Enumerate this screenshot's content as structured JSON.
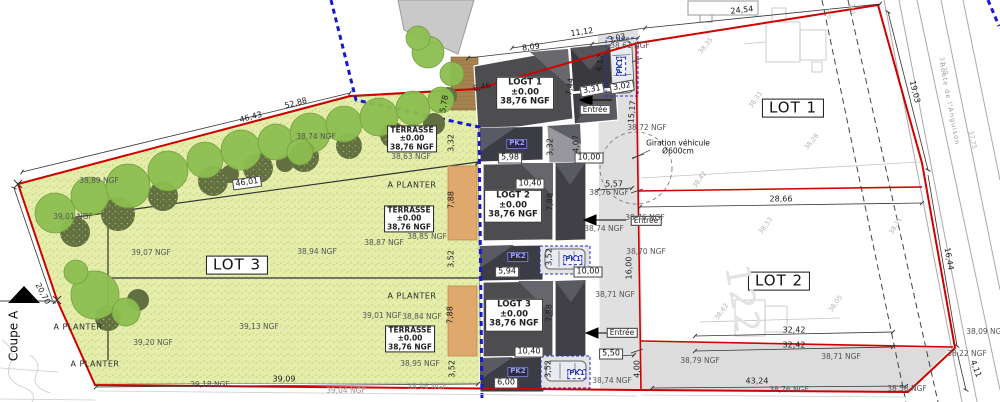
{
  "plan": {
    "type": "plan de masse / site plan",
    "colors": {
      "boundary_red": "#d10000",
      "zone_blue_dashed": "#1818cf",
      "lawn": "#e4edaa",
      "tree_canopy": "#8dbe51",
      "tree_shadow": "#626f40",
      "building_dark": "#4d4d50",
      "terrace_tan": "#dfa96e",
      "drive_gray": "#e0e0e0"
    }
  },
  "labels": [
    {
      "n": "lot1-label",
      "c": "lot",
      "t": "LOT 1",
      "x": 793,
      "y": 108
    },
    {
      "n": "lot2-label",
      "c": "lot",
      "t": "LOT 2",
      "x": 779,
      "y": 281
    },
    {
      "n": "lot3-label",
      "c": "lot",
      "t": "LOT 3",
      "x": 237,
      "y": 265
    },
    {
      "n": "logt1-label",
      "c": "bld",
      "t": "LOGT 1\n±0.00\n38,76 NGF",
      "x": 525,
      "y": 93
    },
    {
      "n": "logt2-label",
      "c": "bld",
      "t": "LOGT 2\n±0.00\n38,76 NGF",
      "x": 513,
      "y": 206
    },
    {
      "n": "logt3-label",
      "c": "bld",
      "t": "LOGT 3\n±0.00\n38,76 NGF",
      "x": 514,
      "y": 315
    },
    {
      "n": "terrasse-label-1",
      "c": "terr",
      "t": "TERRASSE\n±0.00\n38,76 NGF",
      "x": 412,
      "y": 139
    },
    {
      "n": "terrasse-label-2",
      "c": "terr",
      "t": "TERRASSE\n±0.00\n38,76 NGF",
      "x": 409,
      "y": 219
    },
    {
      "n": "terrasse-label-3",
      "c": "terr",
      "t": "TERRASSE\n±0.00\n38,76 NGF",
      "x": 410,
      "y": 339
    },
    {
      "n": "a-planter-label",
      "c": "plant",
      "t": "A PLANTER",
      "x": 412,
      "y": 186
    },
    {
      "n": "a-planter-label",
      "c": "plant",
      "t": "A PLANTER",
      "x": 412,
      "y": 297
    },
    {
      "n": "a-planter-label",
      "c": "plant",
      "t": "A PLANTER",
      "x": 78,
      "y": 328
    },
    {
      "n": "a-planter-label",
      "c": "plant",
      "t": "A PLANTER",
      "x": 95,
      "y": 365
    },
    {
      "n": "entree-label-logt1",
      "c": "ent",
      "t": "Entrée",
      "x": 595,
      "y": 110
    },
    {
      "n": "entree-label-logt2",
      "c": "ent",
      "t": "Entrée",
      "x": 646,
      "y": 221
    },
    {
      "n": "entree-label-logt3",
      "c": "ent",
      "t": "Entrée",
      "x": 622,
      "y": 333
    },
    {
      "n": "giration-label",
      "c": "gir",
      "t": "Giration véhicule\nØ600cm",
      "x": 678,
      "y": 148
    },
    {
      "n": "pk2-label",
      "c": "pk2",
      "t": "PK2",
      "x": 517,
      "y": 144
    },
    {
      "n": "pk2-label",
      "c": "pk2",
      "t": "PK2",
      "x": 518,
      "y": 257
    },
    {
      "n": "pk2-label",
      "c": "pk2",
      "t": "PK2",
      "x": 518,
      "y": 372
    },
    {
      "n": "pk1-label",
      "c": "pk1",
      "t": "PK1",
      "x": 621,
      "y": 66,
      "r": -90
    },
    {
      "n": "pk1-label",
      "c": "pk1",
      "t": "PK1",
      "x": 573,
      "y": 260
    },
    {
      "n": "pk1-label",
      "c": "pk1",
      "t": "PK1",
      "x": 577,
      "y": 374
    },
    {
      "n": "dimension-label",
      "c": "dimbox",
      "t": "46,01",
      "x": 247,
      "y": 183,
      "r": -8
    },
    {
      "n": "dimension-label",
      "c": "dimbox",
      "t": "5,98",
      "x": 510,
      "y": 158
    },
    {
      "n": "dimension-label",
      "c": "dimbox",
      "t": "10,00",
      "x": 589,
      "y": 158
    },
    {
      "n": "dimension-label",
      "c": "dimbox",
      "t": "10,40",
      "x": 530,
      "y": 184
    },
    {
      "n": "dimension-label",
      "c": "dimbox",
      "t": "5,94",
      "x": 507,
      "y": 272
    },
    {
      "n": "dimension-label",
      "c": "dimbox",
      "t": "10,00",
      "x": 588,
      "y": 272
    },
    {
      "n": "dimension-label",
      "c": "dimbox",
      "t": "10,40",
      "x": 529,
      "y": 352
    },
    {
      "n": "dimension-label",
      "c": "dimbox",
      "t": "5,50",
      "x": 611,
      "y": 354
    },
    {
      "n": "dimension-label",
      "c": "dimbox",
      "t": "6,00",
      "x": 506,
      "y": 383
    },
    {
      "n": "dimension-label",
      "c": "dimbox",
      "t": "3,31",
      "x": 592,
      "y": 90,
      "r": -10
    },
    {
      "n": "dimension-label",
      "c": "dimbox",
      "t": "3,02",
      "x": 622,
      "y": 87,
      "r": -10
    },
    {
      "n": "dimension-label",
      "c": "dim",
      "t": "24,54",
      "x": 742,
      "y": 11,
      "r": -6
    },
    {
      "n": "dimension-label",
      "c": "dim",
      "t": "11,12",
      "x": 582,
      "y": 33,
      "r": -8
    },
    {
      "n": "dimension-label",
      "c": "dim",
      "t": "8,09",
      "x": 531,
      "y": 48,
      "r": -7
    },
    {
      "n": "dimension-label",
      "c": "dim",
      "t": "3,03",
      "x": 617,
      "y": 39,
      "r": -12
    },
    {
      "n": "dimension-label",
      "c": "dim",
      "t": "6,46",
      "x": 482,
      "y": 88,
      "r": -11
    },
    {
      "n": "dimension-label",
      "c": "dim",
      "t": "52,88",
      "x": 296,
      "y": 104,
      "r": -15
    },
    {
      "n": "dimension-label",
      "c": "dim",
      "t": "46,43",
      "x": 251,
      "y": 118,
      "r": -15
    },
    {
      "n": "dimension-label",
      "c": "dim",
      "t": "28,66",
      "x": 781,
      "y": 200
    },
    {
      "n": "dimension-label",
      "c": "dim",
      "t": "32,42",
      "x": 794,
      "y": 331
    },
    {
      "n": "dimension-label",
      "c": "dim",
      "t": "32,42",
      "x": 794,
      "y": 346
    },
    {
      "n": "dimension-label",
      "c": "dim",
      "t": "43,24",
      "x": 757,
      "y": 382
    },
    {
      "n": "dimension-label",
      "c": "dim",
      "t": "39,09",
      "x": 284,
      "y": 380
    },
    {
      "n": "dimension-label",
      "c": "dim",
      "t": "5,57",
      "x": 614,
      "y": 185
    },
    {
      "n": "dimension-label",
      "c": "dim",
      "t": "3,32",
      "x": 452,
      "y": 143,
      "r": -90
    },
    {
      "n": "dimension-label",
      "c": "dim",
      "t": "3,32",
      "x": 551,
      "y": 147,
      "r": -90
    },
    {
      "n": "dimension-label",
      "c": "dim",
      "t": "7,88",
      "x": 452,
      "y": 200,
      "r": -90
    },
    {
      "n": "dimension-label",
      "c": "dim",
      "t": "7,88",
      "x": 551,
      "y": 202,
      "r": -90
    },
    {
      "n": "dimension-label",
      "c": "dim",
      "t": "3,52",
      "x": 452,
      "y": 259,
      "r": -90
    },
    {
      "n": "dimension-label",
      "c": "dim",
      "t": "3,52",
      "x": 550,
      "y": 257,
      "r": -90
    },
    {
      "n": "dimension-label",
      "c": "dim",
      "t": "7,88",
      "x": 451,
      "y": 315,
      "r": -90
    },
    {
      "n": "dimension-label",
      "c": "dim",
      "t": "7,88",
      "x": 550,
      "y": 313,
      "r": -90
    },
    {
      "n": "dimension-label",
      "c": "dim",
      "t": "3,52",
      "x": 453,
      "y": 369,
      "r": -90
    },
    {
      "n": "dimension-label",
      "c": "dim",
      "t": "3,52",
      "x": 549,
      "y": 369,
      "r": -90
    },
    {
      "n": "dimension-label",
      "c": "dim",
      "t": "7,44",
      "x": 571,
      "y": 87,
      "r": -82
    },
    {
      "n": "dimension-label",
      "c": "dim",
      "t": "4,17",
      "x": 601,
      "y": 63,
      "r": -82
    },
    {
      "n": "dimension-label",
      "c": "dim",
      "t": "4,07",
      "x": 577,
      "y": 144,
      "r": -90
    },
    {
      "n": "dimension-label",
      "c": "dim",
      "t": "15,17",
      "x": 633,
      "y": 112,
      "r": -84
    },
    {
      "n": "dimension-label",
      "c": "dim",
      "t": "16,00",
      "x": 630,
      "y": 268,
      "r": -90
    },
    {
      "n": "dimension-label",
      "c": "dim",
      "t": "4,00",
      "x": 638,
      "y": 369,
      "r": -90
    },
    {
      "n": "dimension-label",
      "c": "dim",
      "t": "20,70",
      "x": 42,
      "y": 294,
      "r": 62
    },
    {
      "n": "dimension-label",
      "c": "dim",
      "t": "19,03",
      "x": 914,
      "y": 92,
      "r": 76
    },
    {
      "n": "dimension-label",
      "c": "dim",
      "t": "16,44",
      "x": 948,
      "y": 259,
      "r": 80
    },
    {
      "n": "dimension-label",
      "c": "dim",
      "t": "4,11",
      "x": 975,
      "y": 369,
      "r": 70
    },
    {
      "n": "dimension-label",
      "c": "dim",
      "t": "5,78",
      "x": 445,
      "y": 104,
      "r": -80
    },
    {
      "n": "setback-label",
      "c": "survey",
      "t": "5m",
      "x": 828,
      "y": 14,
      "r": 78
    },
    {
      "n": "setback-label",
      "c": "survey",
      "t": "3m",
      "x": 852,
      "y": 9,
      "r": 78
    },
    {
      "n": "elevation-label",
      "c": "ngf",
      "t": "38,61 NGF",
      "x": 630,
      "y": 46
    },
    {
      "n": "elevation-label",
      "c": "ngf",
      "t": "38,72 NGF",
      "x": 647,
      "y": 128
    },
    {
      "n": "elevation-label",
      "c": "ngf",
      "t": "38,76 NGF",
      "x": 609,
      "y": 193
    },
    {
      "n": "elevation-label",
      "c": "ngf",
      "t": "38,76 NGF",
      "x": 645,
      "y": 218
    },
    {
      "n": "elevation-label",
      "c": "ngf",
      "t": "38,74 NGF",
      "x": 604,
      "y": 229
    },
    {
      "n": "elevation-label",
      "c": "ngf",
      "t": "38,70 NGF",
      "x": 646,
      "y": 252
    },
    {
      "n": "elevation-label",
      "c": "ngf",
      "t": "38,71 NGF",
      "x": 615,
      "y": 295
    },
    {
      "n": "elevation-label",
      "c": "ngf",
      "t": "38,79 NGF",
      "x": 700,
      "y": 361
    },
    {
      "n": "elevation-label",
      "c": "ngf",
      "t": "38,71 NGF",
      "x": 841,
      "y": 357
    },
    {
      "n": "elevation-label",
      "c": "ngf",
      "t": "38,22 NGF",
      "x": 967,
      "y": 354
    },
    {
      "n": "elevation-label",
      "c": "ngf",
      "t": "38,09 NGF",
      "x": 986,
      "y": 332
    },
    {
      "n": "elevation-label",
      "c": "ngf",
      "t": "38,58 NGF",
      "x": 907,
      "y": 389
    },
    {
      "n": "elevation-label",
      "c": "ngf",
      "t": "38,76 NGF",
      "x": 789,
      "y": 390
    },
    {
      "n": "elevation-label",
      "c": "ngf",
      "t": "38,74 NGF",
      "x": 612,
      "y": 381
    },
    {
      "n": "elevation-label",
      "c": "ngf",
      "t": "38,89 NGF",
      "x": 99,
      "y": 181
    },
    {
      "n": "elevation-label",
      "c": "ngf",
      "t": "38,74 NGF",
      "x": 316,
      "y": 137
    },
    {
      "n": "elevation-label",
      "c": "ngf",
      "t": "39,07 NGF",
      "x": 151,
      "y": 253
    },
    {
      "n": "elevation-label",
      "c": "ngf",
      "t": "38,94 NGF",
      "x": 317,
      "y": 252
    },
    {
      "n": "elevation-label",
      "c": "ngf",
      "t": "39,01 NGF",
      "x": 73,
      "y": 217
    },
    {
      "n": "elevation-label",
      "c": "ngf",
      "t": "38,87 NGF",
      "x": 384,
      "y": 243
    },
    {
      "n": "elevation-label",
      "c": "ngf",
      "t": "38,85 NGF",
      "x": 427,
      "y": 237
    },
    {
      "n": "elevation-label",
      "c": "ngf",
      "t": "38,63 NGF",
      "x": 411,
      "y": 157
    },
    {
      "n": "elevation-label",
      "c": "ngf",
      "t": "39,20 NGF",
      "x": 153,
      "y": 343
    },
    {
      "n": "elevation-label",
      "c": "ngf",
      "t": "39,13 NGF",
      "x": 259,
      "y": 327
    },
    {
      "n": "elevation-label",
      "c": "ngf",
      "t": "39,01 NGF",
      "x": 382,
      "y": 316
    },
    {
      "n": "elevation-label",
      "c": "ngf",
      "t": "38,84 NGF",
      "x": 422,
      "y": 317
    },
    {
      "n": "elevation-label",
      "c": "ngf",
      "t": "38,95 NGF",
      "x": 420,
      "y": 364
    },
    {
      "n": "elevation-label",
      "c": "ngf",
      "t": "39,18 NGF",
      "x": 210,
      "y": 385
    },
    {
      "n": "elevation-label",
      "c": "ngfl",
      "t": "39,04 NGF",
      "x": 346,
      "y": 391
    },
    {
      "n": "elevation-label",
      "c": "ngfl",
      "t": "38,96 NGF",
      "x": 427,
      "y": 387
    },
    {
      "n": "coupe-a-label",
      "c": "coupe",
      "t": "Coupe A",
      "x": 14,
      "y": 336,
      "r": -90
    },
    {
      "n": "road-name-label",
      "c": "road",
      "t": "Route de l'Anguison",
      "x": 949,
      "y": 104,
      "r": 79
    },
    {
      "n": "parcel-number-label",
      "c": "f122",
      "t": "122",
      "x": 742,
      "y": 300,
      "r": 80
    },
    {
      "n": "survey-point-label",
      "c": "survey",
      "t": "38,35",
      "x": 706,
      "y": 46,
      "r": -50
    },
    {
      "n": "survey-point-label",
      "c": "survey",
      "t": "38,31",
      "x": 756,
      "y": 100,
      "r": -55
    },
    {
      "n": "survey-point-label",
      "c": "survey",
      "t": "38,28",
      "x": 812,
      "y": 142,
      "r": -50
    },
    {
      "n": "survey-point-label",
      "c": "survey",
      "t": "38,11",
      "x": 896,
      "y": 226,
      "r": -60
    },
    {
      "n": "survey-point-label",
      "c": "survey",
      "t": "37,78",
      "x": 943,
      "y": 66,
      "r": 76
    },
    {
      "n": "survey-point-label",
      "c": "survey",
      "t": "37,75",
      "x": 972,
      "y": 140,
      "r": 76
    },
    {
      "n": "survey-point-label",
      "c": "survey",
      "t": "38,05",
      "x": 836,
      "y": 304,
      "r": -55
    },
    {
      "n": "survey-point-label",
      "c": "survey",
      "t": "38,62",
      "x": 722,
      "y": 312,
      "r": -55
    },
    {
      "n": "survey-point-label",
      "c": "survey",
      "t": "38,42",
      "x": 700,
      "y": 180,
      "r": -55
    },
    {
      "n": "survey-point-label",
      "c": "survey",
      "t": "38,33",
      "x": 766,
      "y": 226,
      "r": -55
    }
  ]
}
